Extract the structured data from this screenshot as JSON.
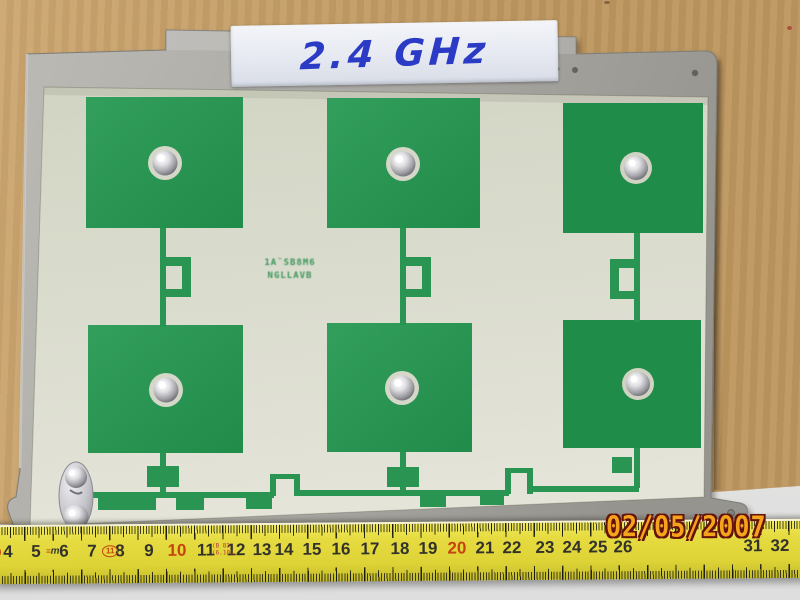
{
  "photo_subject": "2.4 GHz six-patch microstrip antenna array on aluminium plate",
  "label_tape": {
    "text": "2.4 GHz"
  },
  "pcb_marking": {
    "line1": "1A˜SB8M6",
    "line2": "NGLLAVB"
  },
  "date_stamp": "02/05/2007",
  "ruler": {
    "left_mark": "II",
    "logo_prefix": "≡",
    "logo_text": "m",
    "class_mark": "11",
    "stamp_top": "(B 83",
    "stamp_bottom": "(6.101",
    "marks": [
      {
        "label": "4",
        "x": 12
      },
      {
        "label": "5",
        "x": 40
      },
      {
        "label": "6",
        "x": 68
      },
      {
        "label": "7",
        "x": 96
      },
      {
        "label": "8",
        "x": 124
      },
      {
        "label": "9",
        "x": 153
      },
      {
        "label": "10",
        "x": 181,
        "red": true
      },
      {
        "label": "11",
        "x": 210
      },
      {
        "label": "12",
        "x": 240
      },
      {
        "label": "13",
        "x": 266
      },
      {
        "label": "14",
        "x": 288
      },
      {
        "label": "15",
        "x": 316
      },
      {
        "label": "16",
        "x": 345
      },
      {
        "label": "17",
        "x": 374
      },
      {
        "label": "18",
        "x": 404
      },
      {
        "label": "19",
        "x": 432
      },
      {
        "label": "20",
        "x": 461,
        "red": true
      },
      {
        "label": "21",
        "x": 489
      },
      {
        "label": "22",
        "x": 516
      },
      {
        "label": "23",
        "x": 549
      },
      {
        "label": "24",
        "x": 576
      },
      {
        "label": "25",
        "x": 602
      },
      {
        "label": "26",
        "x": 627
      },
      {
        "label": "31",
        "x": 757
      },
      {
        "label": "32",
        "x": 784
      }
    ]
  },
  "palette": {
    "cardboard": "#c79e63",
    "table": "#d6d6d4",
    "plate_light": "#b8b6b1",
    "plate_dark": "#9b9994",
    "pcb_light": "#e0e1d3",
    "pcb_dark": "#d2d4c3",
    "copper_green": "#2a9552",
    "copper_green_dark": "#1f8c49",
    "silkscreen_green": "#2e9050",
    "tape": "#e8ebf2",
    "ink_blue": "#2b3bc6",
    "ruler_yellow": "#e6dc41",
    "ruler_tick": "#32322a",
    "ruler_red": "#c8440e",
    "stamp_orange": "#f3a41c",
    "stamp_outline": "#66120a"
  }
}
